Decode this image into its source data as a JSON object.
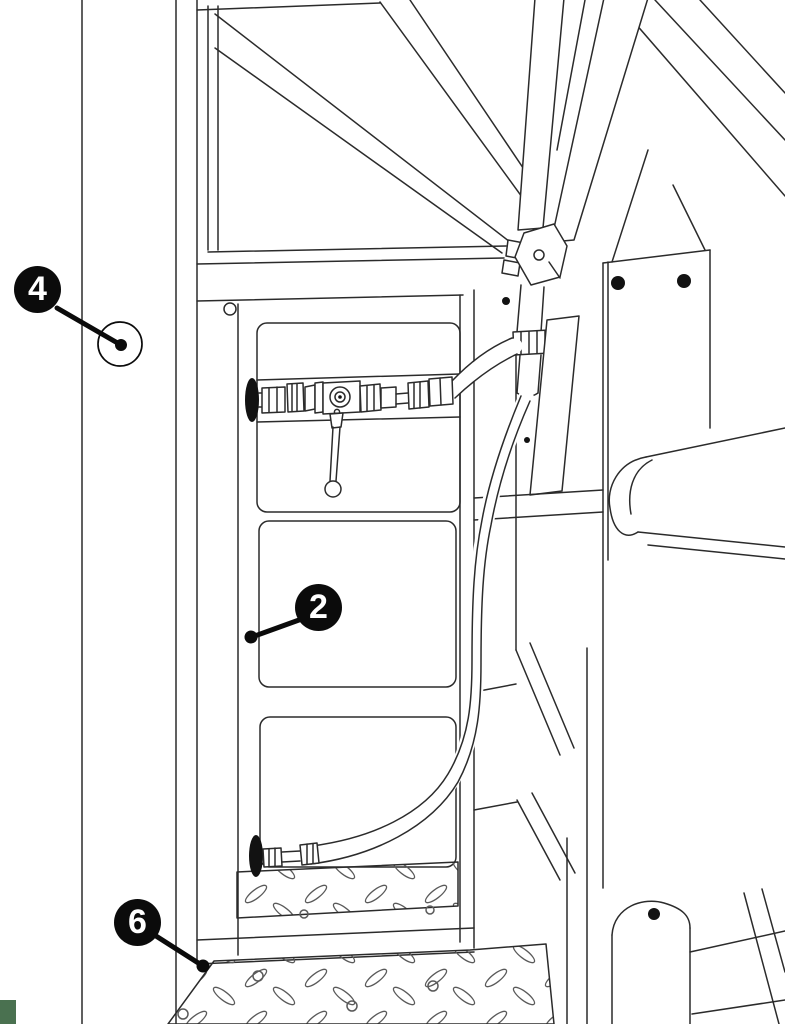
{
  "callouts": [
    {
      "label": "4"
    },
    {
      "label": "2"
    },
    {
      "label": "6"
    }
  ],
  "colors": {
    "background": "#ffffff",
    "line_art": "#2b2b2b",
    "plate_pattern": "#5a5a5a",
    "ink_fill": "#121212",
    "callout_fill": "#0b0b0b",
    "callout_text": "#ffffff",
    "corner_mark": "#4a7150"
  }
}
